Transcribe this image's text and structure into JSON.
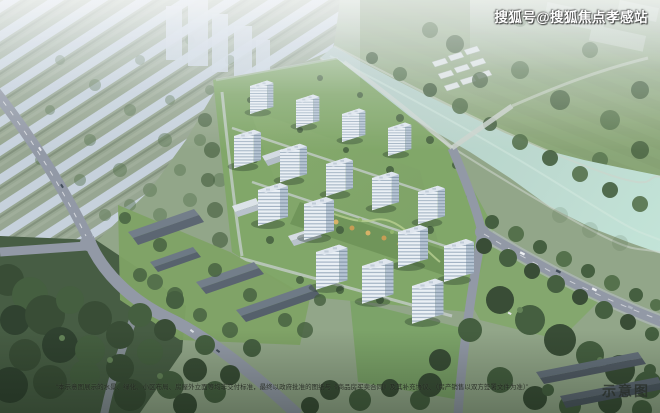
{
  "watermarks": {
    "publisher": "搜狐号@搜狐焦点孝感站",
    "disclaimer": "“本示意图展示的水景、绿化、小区布局、房屋外立面等均非交付标准，最终以政府批准的图纸与《商品房买卖合同》及其补充协议、（房产销售以双方签署文件为准）”",
    "image_type_label": "示意图"
  },
  "palette": {
    "haze": "#c9d2dc",
    "distant_city": "#c7d2dd",
    "river_water": "#bedbce",
    "countryside_green": "#89a671",
    "estate_lawn": "#7ca460",
    "dark_trees": "#3d5438",
    "tower_facade": "#eef3f8",
    "tower_shade": "#b6c4d3",
    "road_asphalt": "#8f95a2",
    "dark_roof": "#525c68"
  }
}
